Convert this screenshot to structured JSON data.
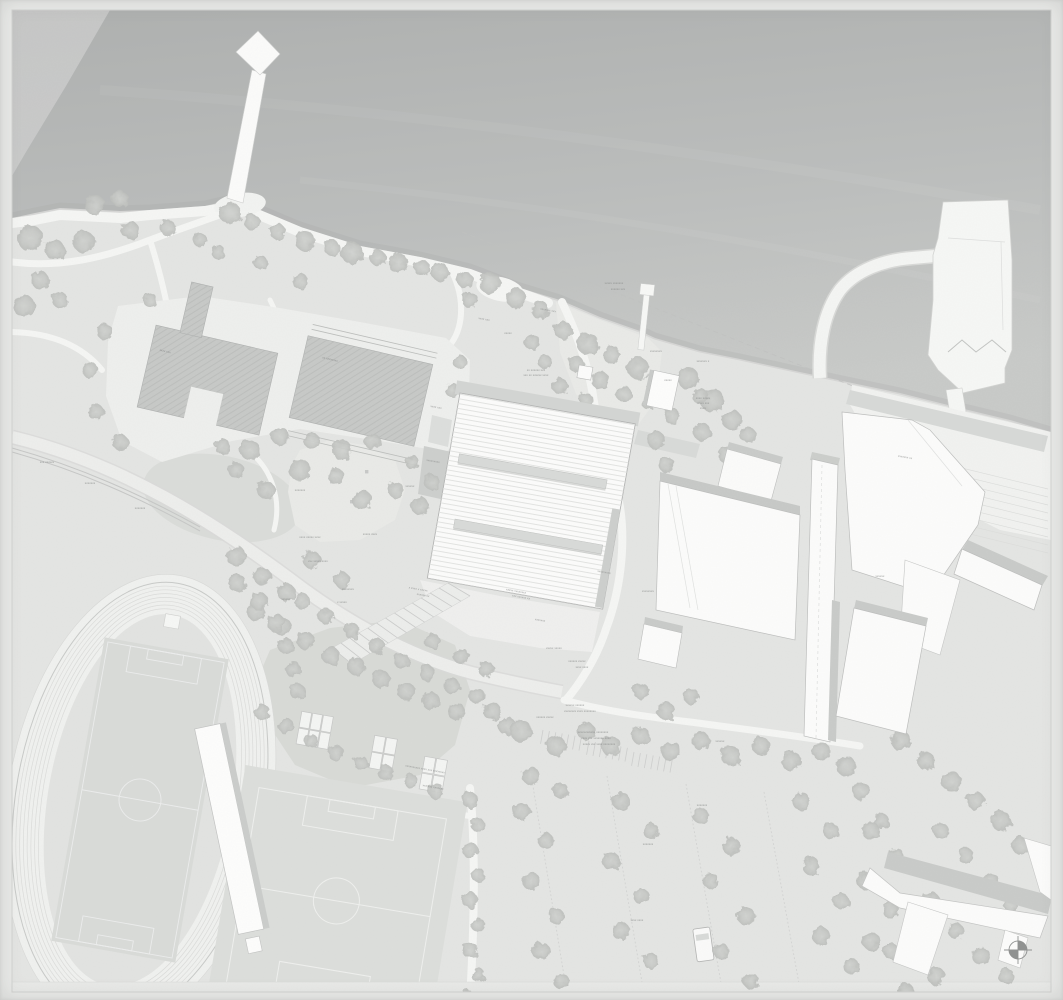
{
  "canvas": {
    "width": 1063,
    "height": 1000
  },
  "palette": {
    "paper": "#e9eae8",
    "land": "#e4e5e3",
    "water_deep": "#b0b2b1",
    "water_shallow": "#c6c8c6",
    "path": "#f5f6f4",
    "road": "#edeeec",
    "building": "#fcfcfb",
    "building_outline": "#b5b6b5",
    "shadow_band": "#c9cbc9",
    "pool_surface": "#c7c9c7",
    "pool_hatch": "#b4b6b4",
    "lawn": "#d8dad7",
    "playground": "#e9eae7",
    "field": "#dcdedb",
    "field_line": "#eff0ee",
    "track": "#f0f1ef",
    "track_lane": "#dbdcda",
    "tree": "#c6c8c5",
    "annotation": "#8a8c8b",
    "boundary": "#bfc1bf",
    "north_arrow": "#8f9190"
  },
  "features": [
    {
      "id": "water-area",
      "kind": "lake"
    },
    {
      "id": "north-pier",
      "kind": "pier with diamond head"
    },
    {
      "id": "small-jetty",
      "kind": "jetty"
    },
    {
      "id": "dock-island",
      "kind": "dock island with causeway"
    },
    {
      "id": "shore-promenade",
      "kind": "waterfront path"
    },
    {
      "id": "beach-area",
      "kind": "beach"
    },
    {
      "id": "west-pool-basin",
      "kind": "outdoor pool"
    },
    {
      "id": "east-pool-basin",
      "kind": "outdoor pool"
    },
    {
      "id": "main-hall-building",
      "kind": "large hall with striped roof and two skylights"
    },
    {
      "id": "entrance-stairs",
      "kind": "stepped ramp"
    },
    {
      "id": "right-building-cluster",
      "kind": "existing building complex"
    },
    {
      "id": "waterfront-terraces",
      "kind": "stepped terraces"
    },
    {
      "id": "athletics-track",
      "kind": "running track with football infield"
    },
    {
      "id": "grandstand-building",
      "kind": "long stand building"
    },
    {
      "id": "south-field",
      "kind": "football field"
    },
    {
      "id": "mini-courts",
      "kind": "small courts"
    },
    {
      "id": "parking-lot",
      "kind": "tree-lined parking"
    },
    {
      "id": "parking-van",
      "kind": "vehicle"
    },
    {
      "id": "chevron-building",
      "kind": "bent building"
    },
    {
      "id": "north-arrow",
      "kind": "compass symbol"
    }
  ],
  "annotations": [
    {
      "x": 614,
      "y": 284,
      "rot": 0,
      "text": "xxxxx xxxxxxx"
    },
    {
      "x": 618,
      "y": 290,
      "rot": 0,
      "text": "xxxxxx xxx"
    },
    {
      "x": 548,
      "y": 311,
      "rot": 10,
      "text": "xxxxxxx xxx"
    },
    {
      "x": 484,
      "y": 320,
      "rot": 10,
      "text": "xxxx xxx"
    },
    {
      "x": 508,
      "y": 334,
      "rot": 0,
      "text": "xxxxx"
    },
    {
      "x": 536,
      "y": 371,
      "rot": 0,
      "text": "xx xxxxxx xxx"
    },
    {
      "x": 536,
      "y": 376,
      "rot": 0,
      "text": "xxx xx xxxxxx xxxx"
    },
    {
      "x": 656,
      "y": 352,
      "rot": 0,
      "text": "xxxxxxxx"
    },
    {
      "x": 703,
      "y": 362,
      "rot": 0,
      "text": "xxxxxxx x"
    },
    {
      "x": 703,
      "y": 399,
      "rot": 0,
      "text": "xxxx xxxxx"
    },
    {
      "x": 703,
      "y": 404,
      "rot": 0,
      "text": "xxxxx xxx"
    },
    {
      "x": 703,
      "y": 409,
      "rot": 0,
      "text": "xxxx"
    },
    {
      "x": 668,
      "y": 381,
      "rot": 0,
      "text": "xxxxx"
    },
    {
      "x": 436,
      "y": 408,
      "rot": 10,
      "text": "xxxx xxx"
    },
    {
      "x": 433,
      "y": 462,
      "rot": 10,
      "text": "xxxxxxxxx"
    },
    {
      "x": 410,
      "y": 487,
      "rot": 0,
      "text": "xxxxxx"
    },
    {
      "x": 300,
      "y": 491,
      "rot": 0,
      "text": "xxxxxxx"
    },
    {
      "x": 370,
      "y": 535,
      "rot": 0,
      "text": "xxxxx xxxx"
    },
    {
      "x": 318,
      "y": 562,
      "rot": 0,
      "text": "xxx xxxxx xxxx"
    },
    {
      "x": 348,
      "y": 590,
      "rot": 0,
      "text": "xxxxxxxx"
    },
    {
      "x": 342,
      "y": 603,
      "rot": 0,
      "text": "x xxxxx"
    },
    {
      "x": 286,
      "y": 600,
      "rot": 0,
      "text": "xxxxxx"
    },
    {
      "x": 418,
      "y": 590,
      "rot": 10,
      "text": "x xxxx x xxxxx"
    },
    {
      "x": 423,
      "y": 596,
      "rot": 10,
      "text": "xxxxxx xx"
    },
    {
      "x": 516,
      "y": 592,
      "rot": 10,
      "text": "xxxxx xxxxxxxx"
    },
    {
      "x": 521,
      "y": 598,
      "rot": 10,
      "text": "xxx xxxxxx xx"
    },
    {
      "x": 540,
      "y": 621,
      "rot": 10,
      "text": "xxxxxxx"
    },
    {
      "x": 604,
      "y": 573,
      "rot": 10,
      "text": "xxxxxxxxx"
    },
    {
      "x": 648,
      "y": 592,
      "rot": 0,
      "text": "xxxxxxxx"
    },
    {
      "x": 554,
      "y": 649,
      "rot": 0,
      "text": "xxxxx xxxxx"
    },
    {
      "x": 577,
      "y": 662,
      "rot": 0,
      "text": "xxxxxx xxxxx"
    },
    {
      "x": 582,
      "y": 668,
      "rot": 0,
      "text": "xxxx xxxx"
    },
    {
      "x": 575,
      "y": 706,
      "rot": 0,
      "text": "xxxxxx xxxxxx"
    },
    {
      "x": 580,
      "y": 712,
      "rot": 0,
      "text": "xxxxxxxx xxxx xxxxxxxx"
    },
    {
      "x": 593,
      "y": 733,
      "rot": 0,
      "text": "xxxxxxxxxxxx xxxxxxxx"
    },
    {
      "x": 596,
      "y": 739,
      "rot": 0,
      "text": "xxxx xxx xxxxxxx xxxx"
    },
    {
      "x": 599,
      "y": 745,
      "rot": 0,
      "text": "xxxxx xxx xxxx xxxxxxxx"
    },
    {
      "x": 310,
      "y": 538,
      "rot": 0,
      "text": "xxxx xxxxx xxxx"
    },
    {
      "x": 140,
      "y": 509,
      "rot": 0,
      "text": "xxxxxxx"
    },
    {
      "x": 90,
      "y": 484,
      "rot": 0,
      "text": "xxxxxxx"
    },
    {
      "x": 47,
      "y": 463,
      "rot": 0,
      "text": "xxx xxxxxx"
    },
    {
      "x": 165,
      "y": 352,
      "rot": 13,
      "text": "xxxx xxx"
    },
    {
      "x": 330,
      "y": 360,
      "rot": 13,
      "text": "xx xxxxxxxx"
    },
    {
      "x": 905,
      "y": 458,
      "rot": 10,
      "text": "xxxxxxx xx"
    },
    {
      "x": 880,
      "y": 577,
      "rot": 0,
      "text": "xxxxxx"
    },
    {
      "x": 425,
      "y": 770,
      "rot": 10,
      "text": "xxxxxxxxxx xxxx xxx xxxxxxxx"
    },
    {
      "x": 433,
      "y": 788,
      "rot": 10,
      "text": "xxx xxx xxxxxxx"
    },
    {
      "x": 545,
      "y": 718,
      "rot": 0,
      "text": "xxxxxx xxxxx"
    },
    {
      "x": 648,
      "y": 845,
      "rot": 0,
      "text": "xxxxxxx"
    },
    {
      "x": 702,
      "y": 806,
      "rot": 0,
      "text": "xxxxxxx"
    },
    {
      "x": 720,
      "y": 742,
      "rot": 0,
      "text": "xxxxxx"
    },
    {
      "x": 637,
      "y": 921,
      "rot": 0,
      "text": "xxxx xxxx"
    }
  ]
}
